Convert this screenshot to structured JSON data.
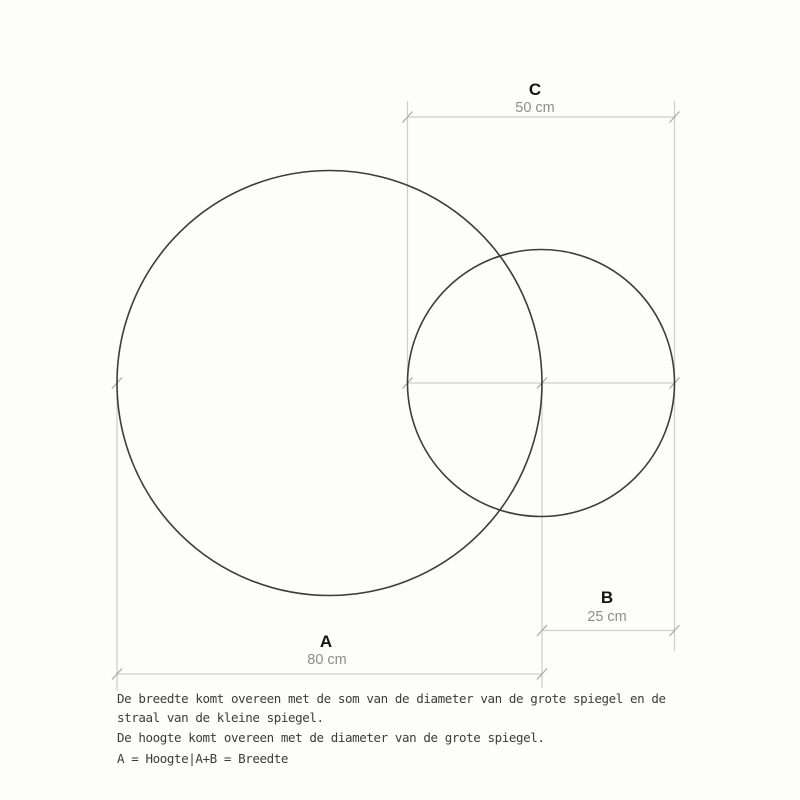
{
  "dimensions": {
    "C": {
      "letter": "C",
      "value": "50 cm"
    },
    "B": {
      "letter": "B",
      "value": "25 cm"
    },
    "A": {
      "letter": "A",
      "value": "80 cm"
    }
  },
  "notes": [
    "De breedte komt overeen met de som van de diameter van de grote spiegel en de",
    "straal van de kleine spiegel.",
    "De hoogte komt overeen met de diameter van de grote spiegel.",
    "A = Hoogte|A+B = Breedte"
  ],
  "colors": {
    "background": "#fdfdfc",
    "circle_stroke": "#3c3c3c",
    "dimension_line": "#cecece",
    "tick": "#a8a8a8",
    "label_letter": "#141414",
    "label_value": "#8e8e8e",
    "notes_text": "#3b3b3b"
  }
}
